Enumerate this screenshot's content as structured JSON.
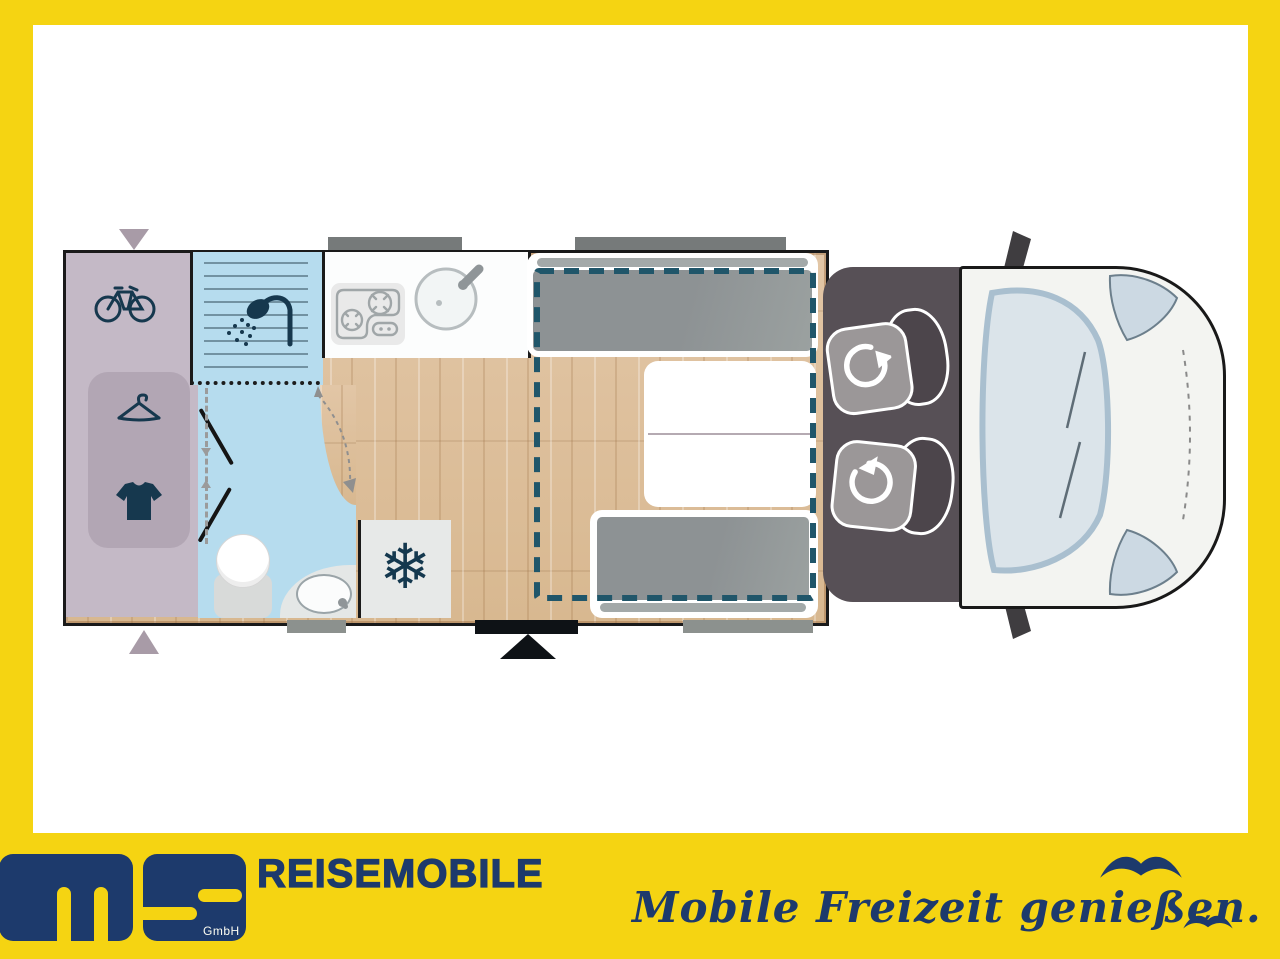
{
  "branding": {
    "company_suffix": "GmbH",
    "wordmark": "REISEMOBILE",
    "tagline": "Mobile Freizeit genießen."
  },
  "glyphs": {
    "snowflake": "❄"
  },
  "colors": {
    "frame_yellow": "#F5D412",
    "brand_navy": "#1D3A6C",
    "bed_dash_teal": "#20566A",
    "wood_floor": "#DFC2A0",
    "wet_area_blue": "#B6DCEE",
    "garage_mauve": "#C4B9C6",
    "cab_floor_gray": "#575056",
    "icon_navy": "#16384E",
    "van_body_white": "#F3F4F1"
  }
}
